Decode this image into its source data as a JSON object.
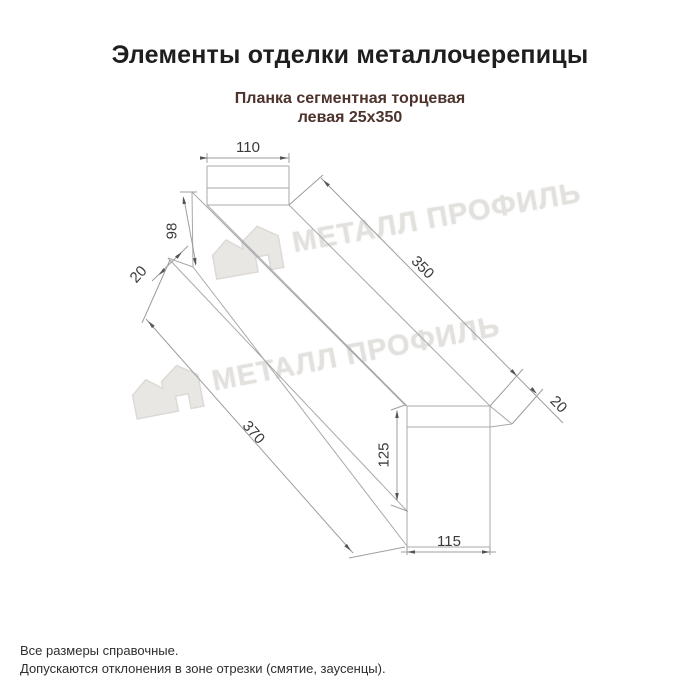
{
  "page": {
    "title": "Элементы отделки металлочерепицы",
    "background": "#ffffff"
  },
  "product": {
    "subtitle_line1": "Планка сегментная торцевая",
    "subtitle_line2": "левая 25х350"
  },
  "drawing": {
    "dimensions": {
      "flange_width": "110",
      "near_face_height": "98",
      "near_hem": "20",
      "length_top": "350",
      "length_bottom": "370",
      "far_hem": "20",
      "end_face_height": "125",
      "end_face_width": "115"
    },
    "line_color": "#a6a9ab",
    "dim_text_color": "#3a3a3a"
  },
  "watermark": {
    "text": "МЕТАЛЛ ПРОФИЛЬ",
    "logo": "metall-profil-house-icon",
    "color": "#e3e1de"
  },
  "footer": {
    "note1": "Все размеры справочные.",
    "note2": "Допускаются отклонения в зоне отрезки (смятие, заусенцы)."
  },
  "colors": {
    "title": "#1e1e1e",
    "subtitle": "#4d332c",
    "footer_text": "#2e2e2e"
  }
}
